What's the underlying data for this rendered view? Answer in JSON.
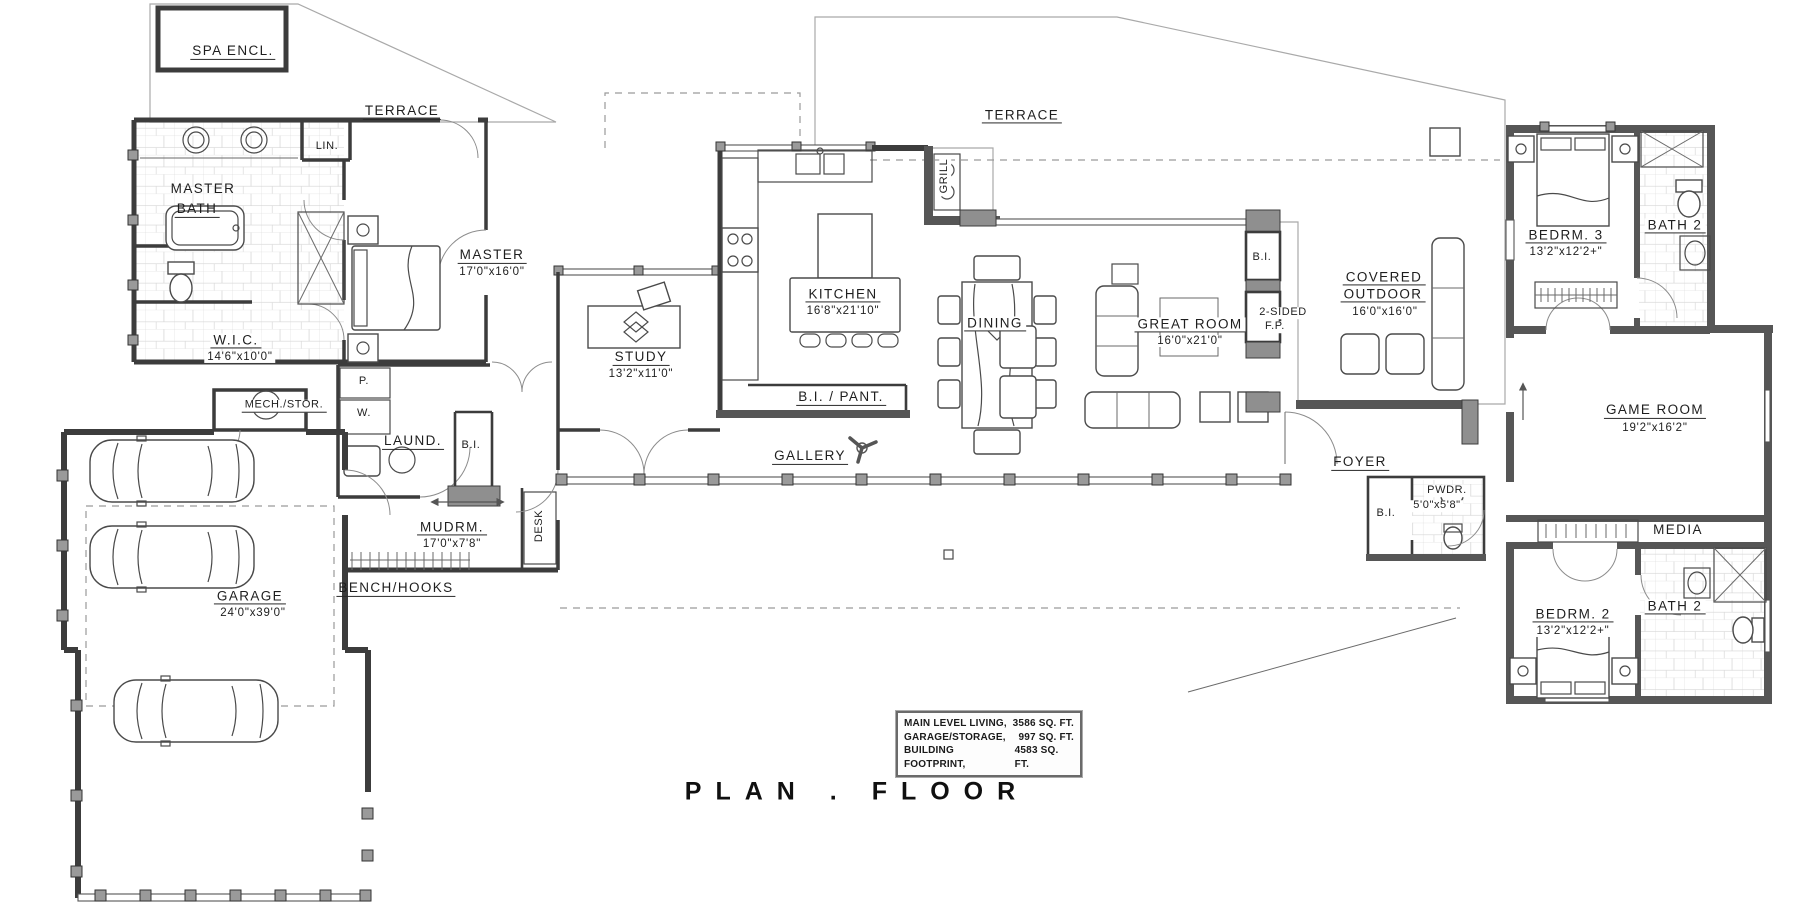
{
  "title": "PLAN . FLOOR",
  "stats": {
    "rows": [
      {
        "label": "MAIN LEVEL LIVING,",
        "value": "3586 SQ. FT."
      },
      {
        "label": "GARAGE/STORAGE,",
        "value": "997 SQ. FT."
      },
      {
        "label": "BUILDING FOOTPRINT,",
        "value": "4583 SQ. FT."
      }
    ]
  },
  "rooms": {
    "spa": {
      "name": "SPA ENCL."
    },
    "terrace_left": {
      "name": "TERRACE"
    },
    "terrace_right": {
      "name": "TERRACE"
    },
    "lin": {
      "name": "LIN."
    },
    "master_bath": {
      "line1": "MASTER",
      "line2": "BATH"
    },
    "wic": {
      "name": "W.I.C.",
      "dim": "14'6\"x10'0\""
    },
    "master": {
      "name": "MASTER",
      "dim": "17'0\"x16'0\""
    },
    "mech": {
      "name": "MECH./STOR."
    },
    "laundry": {
      "name": "LAUND.",
      "p": "P.",
      "w": "W.",
      "bi": "B.I."
    },
    "mudroom": {
      "name": "MUDRM.",
      "dim": "17'0\"x7'8\"",
      "desk": "DESK",
      "bench": "BENCH/HOOKS"
    },
    "garage": {
      "name": "GARAGE",
      "dim": "24'0\"x39'0\""
    },
    "study": {
      "name": "STUDY",
      "dim": "13'2\"x11'0\""
    },
    "kitchen": {
      "name": "KITCHEN",
      "dim": "16'8\"x21'10\""
    },
    "bi_pant": {
      "name": "B.I. / PANT."
    },
    "gallery": {
      "name": "GALLERY"
    },
    "grill": {
      "name": "GRILL"
    },
    "dining": {
      "name": "DINING"
    },
    "great_room": {
      "name": "GREAT ROOM",
      "dim": "16'0\"x21'0\""
    },
    "fireplace": {
      "bi": "B.I.",
      "line1": "2-SIDED",
      "line2": "F.P."
    },
    "covered_outdoor": {
      "line1": "COVERED",
      "line2": "OUTDOOR",
      "dim": "16'0\"x16'0\""
    },
    "bedroom3": {
      "name": "BEDRM. 3",
      "dim": "13'2\"x12'2+\""
    },
    "bath3": {
      "name": "BATH 2"
    },
    "game_room": {
      "name": "GAME ROOM",
      "dim": "19'2\"x16'2\""
    },
    "foyer": {
      "name": "FOYER"
    },
    "powder": {
      "name": "PWDR.",
      "dim": "5'0\"x5'8\"",
      "bi": "B.I."
    },
    "media": {
      "name": "MEDIA"
    },
    "bedroom2": {
      "name": "BEDRM. 2",
      "dim": "13'2\"x12'2+\""
    },
    "bath2": {
      "name": "BATH 2"
    }
  }
}
